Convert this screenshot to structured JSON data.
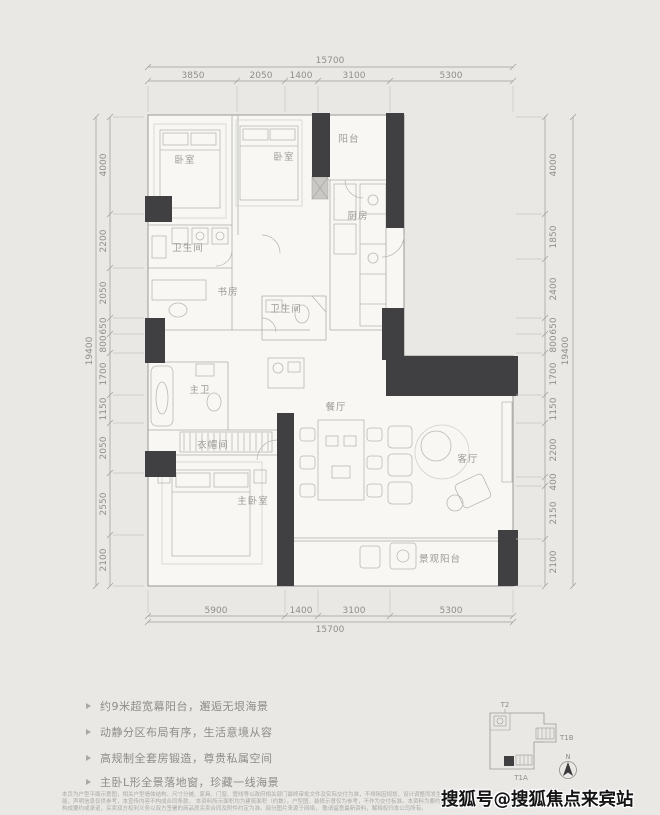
{
  "floor_plan": {
    "dim_top": {
      "total": "15700",
      "segments": [
        "3850",
        "2050",
        "1400",
        "3100",
        "5300"
      ]
    },
    "dim_bottom": {
      "total": "15700",
      "segments": [
        "5900",
        "1400",
        "3100",
        "5300"
      ]
    },
    "dim_left": {
      "total": "19400",
      "segments": [
        "4000",
        "2200",
        "2050",
        "650",
        "800",
        "1700",
        "1150",
        "2050",
        "2550",
        "2100"
      ]
    },
    "dim_right": {
      "total": "19400",
      "segments": [
        "4000",
        "1850",
        "2400",
        "650",
        "800",
        "1700",
        "1150",
        "2200",
        "400",
        "2150",
        "2100"
      ]
    },
    "rooms": {
      "bedroom_1": "卧室",
      "bedroom_2": "卧室",
      "balcony_top": "阳台",
      "kitchen": "厨房",
      "bathroom_1": "卫生间",
      "bathroom_2": "卫生间",
      "study": "书房",
      "master_bathroom": "主卫",
      "walk_in_closet": "衣帽间",
      "master_bedroom": "主卧室",
      "dining_room": "餐厅",
      "living_room": "客厅",
      "view_balcony": "景观阳台"
    }
  },
  "selling_points": [
    "约9米超宽幕阳台，邂逅无垠海景",
    "动静分区布局有序，生活意境从容",
    "高规制全套房锻造，尊贵私属空间",
    "主卧L形全景落地窗，珍藏一线海景"
  ],
  "key_plan": {
    "label_top": "T2",
    "label_right": "T1B",
    "label_bottom": "T1A",
    "compass_north": "N"
  },
  "disclaimer_lines": [
    "本页为户型平面示意图，相关户型墙体结构、尺寸分摊、家具、门窗、管线等以政府相关部门最终审批文件及实际交付为准，不排除因规划、设计调整而发生变化的可能，声明信息仅供参考，本宣传内容不构成合同条款，",
    "本资料所示面积均为建筑面积（约数），户型图、装修示意仅为参考，不作为交付标准。本资料为要约邀请，不构成要约或承诺，买卖双方权利义务以双方签署的商品房买卖合同及附件约定为准。部分图片来源于网络，",
    "敬请留意最新资料，解释权归本公司所有。"
  ],
  "watermark": "搜狐号@搜狐焦点来宾站",
  "colors": {
    "wall": "#403f41",
    "plan_fill": "#f8f7f4",
    "line": "#a9a8a4",
    "dim": "#8f8e8a",
    "background": "#e9e8e5"
  }
}
